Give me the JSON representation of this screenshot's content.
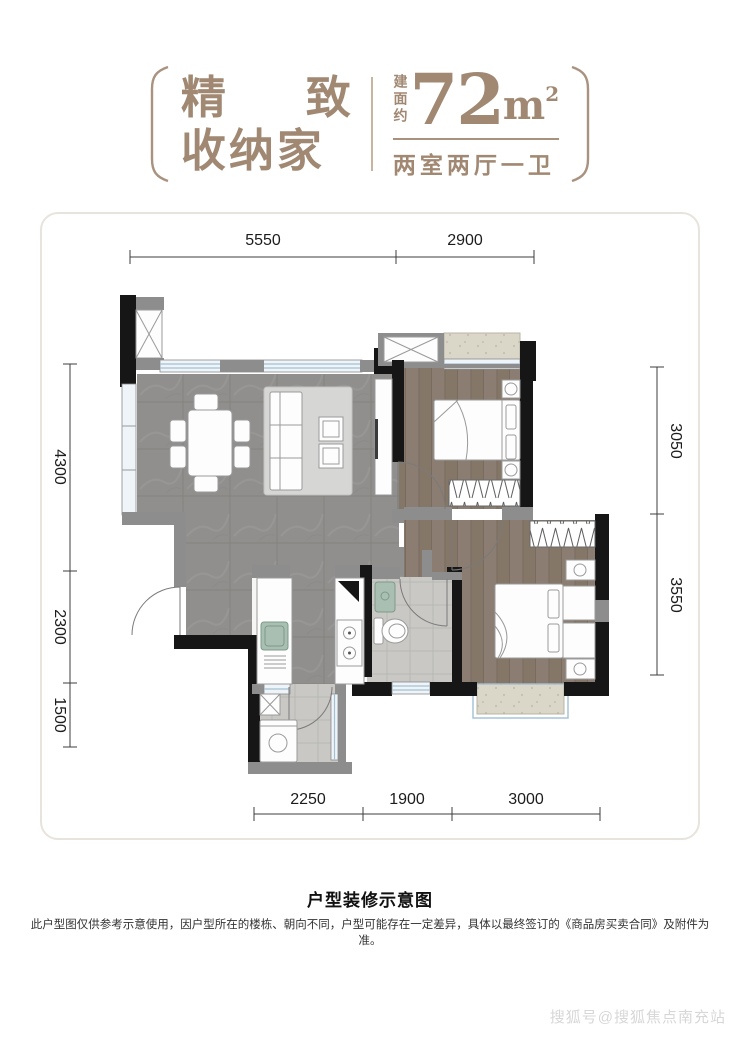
{
  "header": {
    "title_char1": "精",
    "title_char2": "致",
    "title_line2": "收纳家",
    "area_label": "建面约",
    "area_value": "72",
    "area_unit": "m",
    "area_exponent": "2",
    "type_desc": "两室两厅一卫"
  },
  "dimensions": {
    "top": [
      "5550",
      "2900"
    ],
    "left": [
      "4300",
      "2300",
      "1500"
    ],
    "right": [
      "3050",
      "3550"
    ],
    "bottom": [
      "2250",
      "1900",
      "3000"
    ]
  },
  "footer": {
    "caption": "户型装修示意图",
    "disclaimer": "此户型图仅供参考示意使用，因户型所在的楼栋、朝向不同，户型可能存在一定差异，具体以最终签订的《商品房买卖合同》及附件为准。",
    "watermark": "搜狐号@搜狐焦点南充站"
  },
  "colors": {
    "brand_brown": "#a18873",
    "wall_black": "#161616",
    "wall_gray": "#8d8d8d",
    "window_blue": "#a3c0d2",
    "living_tile": "#908f8d",
    "wood_floor": "#8b7d71",
    "bath_tile": "#c9c8c4",
    "bay_beige": "#dad6c8"
  }
}
